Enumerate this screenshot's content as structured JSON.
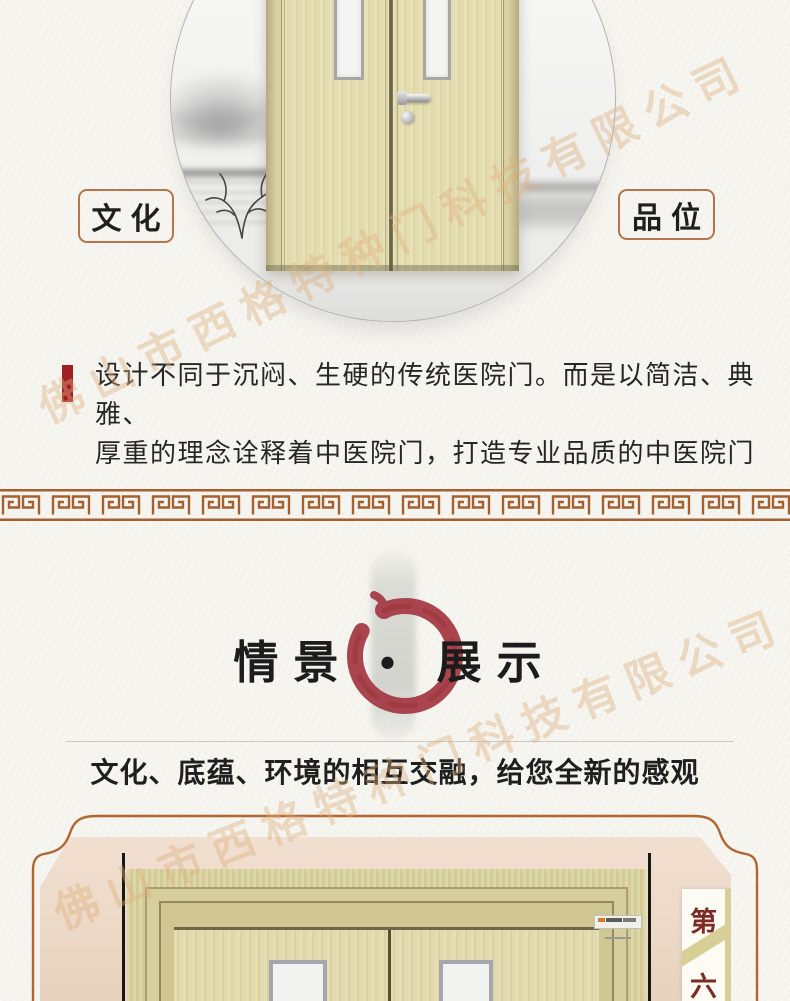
{
  "watermark": {
    "text": "佛山市西格特种门科技有限公司",
    "color": "#deb07e"
  },
  "hero": {
    "left_label": "文化",
    "right_label": "品位"
  },
  "intro": {
    "line1": "设计不同于沉闷、生硬的传统医院门。而是以简洁、典雅、",
    "line2": "厚重的理念诠释着中医院门，打造专业品质的中医院门"
  },
  "showcase": {
    "title": "情景 • 展示",
    "subtitle": "文化、底蕴、环境的相互交融，给您全新的感观"
  },
  "badge": {
    "top": "第",
    "bottom": "六"
  },
  "colors": {
    "accent_red": "#a01d22",
    "enso_red": "#a63c46",
    "tag_border_brown": "#b5744b",
    "meander_brown": "#a4602e",
    "frame_orange": "#b2652f",
    "paper": "#f5f4ef",
    "wall_beige": "#ecd8c6",
    "door_wood": "#ded6a8"
  }
}
